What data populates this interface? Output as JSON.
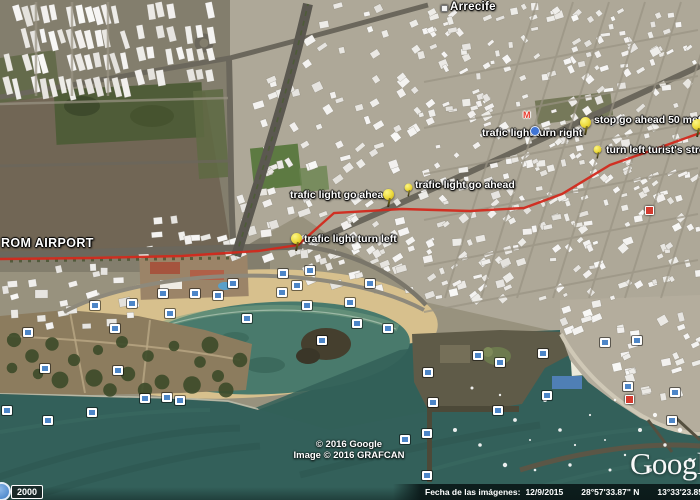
{
  "map_labels": {
    "city": "Arrecife",
    "origin": "ROM AIRPORT"
  },
  "route": {
    "color": "#d2291c",
    "markers": [
      {
        "label": "trafic light go ahead"
      },
      {
        "label": "trafic light go ahead"
      },
      {
        "label": "trafic light turn left"
      },
      {
        "label": "trafic light turn right"
      },
      {
        "label": "stop go ahead 50 meters"
      },
      {
        "label": "turn left turist's street"
      }
    ]
  },
  "poi": {
    "red_m": "M"
  },
  "attribution": {
    "line1": "© 2016 Google",
    "line2": "Image © 2016 GRAFCAN"
  },
  "logo": {
    "text": "Google"
  },
  "status_bar": {
    "imagery_date_label": "Fecha de las imágenes:",
    "imagery_date": "12/9/2015",
    "latitude": "28°57'33.87\" N",
    "longitude": "13°33'23.85\" O",
    "elevation_label": "elev.",
    "elevation": "5 m"
  },
  "scale": {
    "value": "2000"
  }
}
